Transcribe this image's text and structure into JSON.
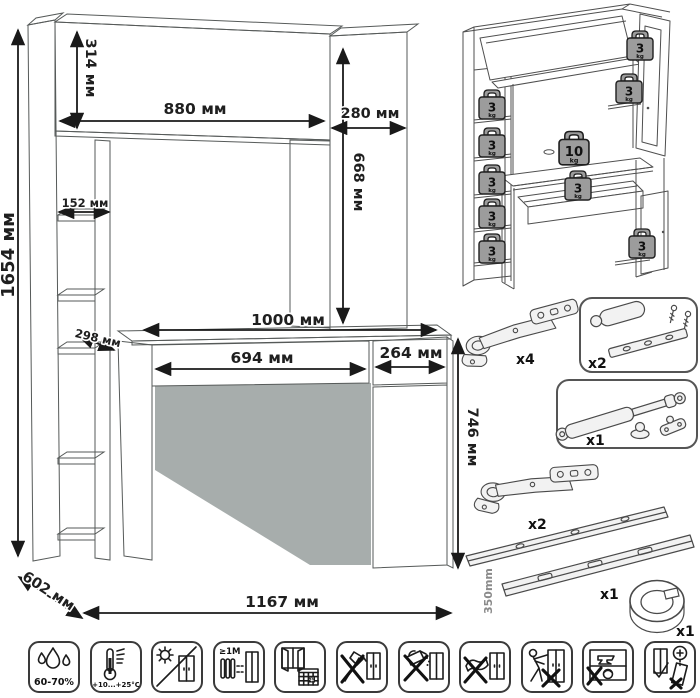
{
  "main_diagram": {
    "dims": {
      "total_height": "1654 мм",
      "hutch_height": "314 мм",
      "hutch_width": "880 мм",
      "side_column_width": "280 мм",
      "opening_height": "668 мм",
      "shelf_width": "152 мм",
      "shelf_depth": "298 мм",
      "desktop_width": "1000 мм",
      "drawer_width": "694 мм",
      "door_width": "264 мм",
      "desk_height": "746 мм",
      "depth": "602 мм",
      "total_width": "1167 мм"
    }
  },
  "load_diagram": {
    "weights": [
      {
        "value": "3",
        "unit": "kg"
      },
      {
        "value": "3",
        "unit": "kg"
      },
      {
        "value": "3",
        "unit": "kg"
      },
      {
        "value": "3",
        "unit": "kg"
      },
      {
        "value": "3",
        "unit": "kg"
      },
      {
        "value": "3",
        "unit": "kg"
      },
      {
        "value": "3",
        "unit": "kg"
      },
      {
        "value": "10",
        "unit": "kg"
      },
      {
        "value": "3",
        "unit": "kg"
      },
      {
        "value": "3",
        "unit": "kg"
      }
    ]
  },
  "hardware": {
    "items": [
      {
        "name": "euro-hinge",
        "qty": "x4"
      },
      {
        "name": "push-latch",
        "qty": "x2"
      },
      {
        "name": "gas-lift",
        "qty": "x1"
      },
      {
        "name": "euro-hinge-2",
        "qty": "x2"
      },
      {
        "name": "drawer-slides",
        "qty": "x1",
        "length": "350mm"
      },
      {
        "name": "cable-grommet",
        "qty": "x1"
      }
    ]
  },
  "care_icons": {
    "items": [
      {
        "name": "humidity",
        "text": "60-70%"
      },
      {
        "name": "temperature",
        "text": "+10...+25°C"
      },
      {
        "name": "no-direct-sunlight"
      },
      {
        "name": "heater-distance",
        "text": "≥1M"
      },
      {
        "name": "ventilation",
        "calendar_day": "25"
      },
      {
        "name": "no-sharp-tools"
      },
      {
        "name": "no-spilling-liquids"
      },
      {
        "name": "no-wet-cleaning"
      },
      {
        "name": "no-moving-loaded"
      },
      {
        "name": "no-heavy-objects-inside"
      },
      {
        "name": "anchor-to-wall"
      }
    ]
  }
}
